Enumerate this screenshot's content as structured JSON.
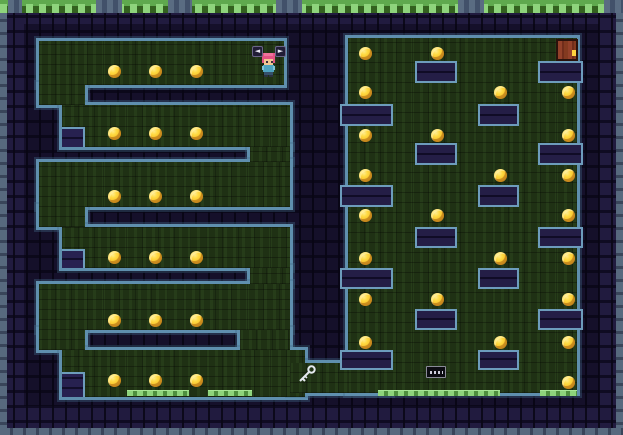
{
  "meta": {
    "scene": "pixel-art dungeon maze level",
    "canvas": {
      "width": 623,
      "height": 435
    }
  },
  "colors": {
    "wall_base": "#171231",
    "wall_block": "#211b3f",
    "edge_ring_blue": "#5f8fae",
    "outer_stone_light": "#57697e",
    "outer_stone_dark": "#39455a",
    "green_floor": "#1f3114",
    "grass_bright": "#8ed47c",
    "grass_mid": "#5fa94e",
    "coin_gold": "#ffd940",
    "coin_shadow": "#dd9426",
    "door_wood": "#93412a",
    "door_frame": "#2a120c",
    "keyhole_yellow": "#ffd23e",
    "player_hair": "#e45383",
    "player_skin": "#f2c692",
    "player_shirt": "#4fa3c0",
    "player_sleeve": "#7fc4da",
    "player_pants": "#35506b",
    "player_feet": "#2a3140",
    "key_metal": "#e4e8ee",
    "hint_key_bg": "#211d36"
  },
  "interior_shade": {
    "x": 24,
    "y": 24,
    "w": 575,
    "h": 382
  },
  "outer_edges": [
    {
      "x": 0,
      "y": 12,
      "w": 7,
      "h": 423,
      "dir": "v"
    },
    {
      "x": 616,
      "y": 12,
      "w": 7,
      "h": 423,
      "dir": "v"
    },
    {
      "x": 0,
      "y": 428,
      "w": 623,
      "h": 7,
      "dir": "h"
    }
  ],
  "grass_top": {
    "x": 0,
    "y": 0,
    "w": 623,
    "h": 13,
    "breaks": [
      [
        8,
        14
      ],
      [
        96,
        26
      ],
      [
        168,
        24
      ],
      [
        276,
        26
      ],
      [
        458,
        26
      ],
      [
        604,
        19
      ]
    ]
  },
  "floor_grass": [
    {
      "x": 127,
      "y": 390,
      "w": 62
    },
    {
      "x": 208,
      "y": 390,
      "w": 44
    },
    {
      "x": 378,
      "y": 390,
      "w": 122
    },
    {
      "x": 540,
      "y": 390,
      "w": 37
    }
  ],
  "green_areas": [
    {
      "x": 39,
      "y": 41,
      "w": 245,
      "h": 44,
      "name": "corridor-1"
    },
    {
      "x": 39,
      "y": 85,
      "w": 46,
      "h": 20,
      "name": "gap-left-1-2"
    },
    {
      "x": 62,
      "y": 105,
      "w": 228,
      "h": 42,
      "name": "corridor-2"
    },
    {
      "x": 250,
      "y": 147,
      "w": 40,
      "h": 15,
      "name": "gap-right-2-3"
    },
    {
      "x": 39,
      "y": 162,
      "w": 251,
      "h": 45,
      "name": "corridor-3"
    },
    {
      "x": 39,
      "y": 207,
      "w": 46,
      "h": 20,
      "name": "gap-left-3-4"
    },
    {
      "x": 62,
      "y": 227,
      "w": 228,
      "h": 41,
      "name": "corridor-4"
    },
    {
      "x": 250,
      "y": 268,
      "w": 40,
      "h": 16,
      "name": "gap-right-4-5"
    },
    {
      "x": 39,
      "y": 284,
      "w": 251,
      "h": 46,
      "name": "corridor-5"
    },
    {
      "x": 39,
      "y": 330,
      "w": 46,
      "h": 20,
      "name": "gap-left-5-6"
    },
    {
      "x": 240,
      "y": 330,
      "w": 50,
      "h": 20,
      "name": "gap-right-5-6"
    },
    {
      "x": 62,
      "y": 350,
      "w": 243,
      "h": 47,
      "name": "corridor-6-bottom"
    },
    {
      "x": 290,
      "y": 363,
      "w": 100,
      "h": 30,
      "name": "bottom-passage"
    },
    {
      "x": 348,
      "y": 38,
      "w": 229,
      "h": 355,
      "name": "right-room"
    }
  ],
  "wall_blocks": [
    {
      "x": 415,
      "y": 61,
      "w": 42,
      "h": 22,
      "kind": "platform"
    },
    {
      "x": 478,
      "y": 104,
      "w": 41,
      "h": 22,
      "kind": "platform"
    },
    {
      "x": 415,
      "y": 143,
      "w": 42,
      "h": 22,
      "kind": "platform"
    },
    {
      "x": 478,
      "y": 185,
      "w": 41,
      "h": 22,
      "kind": "platform"
    },
    {
      "x": 415,
      "y": 227,
      "w": 42,
      "h": 21,
      "kind": "platform"
    },
    {
      "x": 478,
      "y": 268,
      "w": 41,
      "h": 21,
      "kind": "platform"
    },
    {
      "x": 415,
      "y": 309,
      "w": 42,
      "h": 21,
      "kind": "platform"
    },
    {
      "x": 478,
      "y": 350,
      "w": 41,
      "h": 20,
      "kind": "platform"
    },
    {
      "x": 340,
      "y": 104,
      "w": 53,
      "h": 22,
      "kind": "protrusion-left"
    },
    {
      "x": 340,
      "y": 185,
      "w": 53,
      "h": 22,
      "kind": "protrusion-left"
    },
    {
      "x": 340,
      "y": 268,
      "w": 53,
      "h": 21,
      "kind": "protrusion-left"
    },
    {
      "x": 340,
      "y": 350,
      "w": 53,
      "h": 20,
      "kind": "protrusion-left"
    },
    {
      "x": 538,
      "y": 61,
      "w": 45,
      "h": 22,
      "kind": "protrusion-right"
    },
    {
      "x": 538,
      "y": 143,
      "w": 45,
      "h": 22,
      "kind": "protrusion-right"
    },
    {
      "x": 538,
      "y": 227,
      "w": 45,
      "h": 21,
      "kind": "protrusion-right"
    },
    {
      "x": 538,
      "y": 309,
      "w": 45,
      "h": 21,
      "kind": "protrusion-right"
    }
  ],
  "stair_steps": [
    {
      "x": 62,
      "y": 127,
      "w": 23,
      "h": 20
    },
    {
      "x": 62,
      "y": 249,
      "w": 23,
      "h": 19
    },
    {
      "x": 62,
      "y": 372,
      "w": 23,
      "h": 25
    }
  ],
  "coins": [
    [
      114,
      71
    ],
    [
      155,
      71
    ],
    [
      196,
      71
    ],
    [
      114,
      133
    ],
    [
      155,
      133
    ],
    [
      196,
      133
    ],
    [
      114,
      196
    ],
    [
      155,
      196
    ],
    [
      196,
      196
    ],
    [
      114,
      257
    ],
    [
      155,
      257
    ],
    [
      196,
      257
    ],
    [
      114,
      320
    ],
    [
      155,
      320
    ],
    [
      196,
      320
    ],
    [
      114,
      380
    ],
    [
      155,
      380
    ],
    [
      196,
      380
    ],
    [
      365,
      53
    ],
    [
      437,
      53
    ],
    [
      365,
      92
    ],
    [
      500,
      92
    ],
    [
      568,
      92
    ],
    [
      365,
      135
    ],
    [
      437,
      135
    ],
    [
      568,
      135
    ],
    [
      365,
      175
    ],
    [
      500,
      175
    ],
    [
      568,
      175
    ],
    [
      365,
      215
    ],
    [
      437,
      215
    ],
    [
      568,
      215
    ],
    [
      365,
      258
    ],
    [
      500,
      258
    ],
    [
      568,
      258
    ],
    [
      365,
      299
    ],
    [
      437,
      299
    ],
    [
      568,
      299
    ],
    [
      365,
      342
    ],
    [
      500,
      342
    ],
    [
      568,
      342
    ],
    [
      568,
      382
    ]
  ],
  "entities": {
    "player": {
      "x": 261,
      "y": 53,
      "w": 15,
      "h": 24
    },
    "hints": [
      {
        "x": 252,
        "y": 46,
        "w": 11,
        "h": 11,
        "glyph": "◄",
        "name": "movement-hint-left-key"
      },
      {
        "x": 275,
        "y": 46,
        "w": 11,
        "h": 11,
        "glyph": "►",
        "name": "movement-hint-right-key"
      }
    ],
    "door": {
      "x": 556,
      "y": 39,
      "w": 22,
      "h": 22,
      "keyhole": {
        "x": 14,
        "y": 9,
        "w": 4,
        "h": 6
      }
    },
    "key": {
      "x": 296,
      "y": 364,
      "w": 22,
      "h": 22
    },
    "sign": {
      "x": 426,
      "y": 366,
      "w": 20,
      "h": 12
    }
  }
}
